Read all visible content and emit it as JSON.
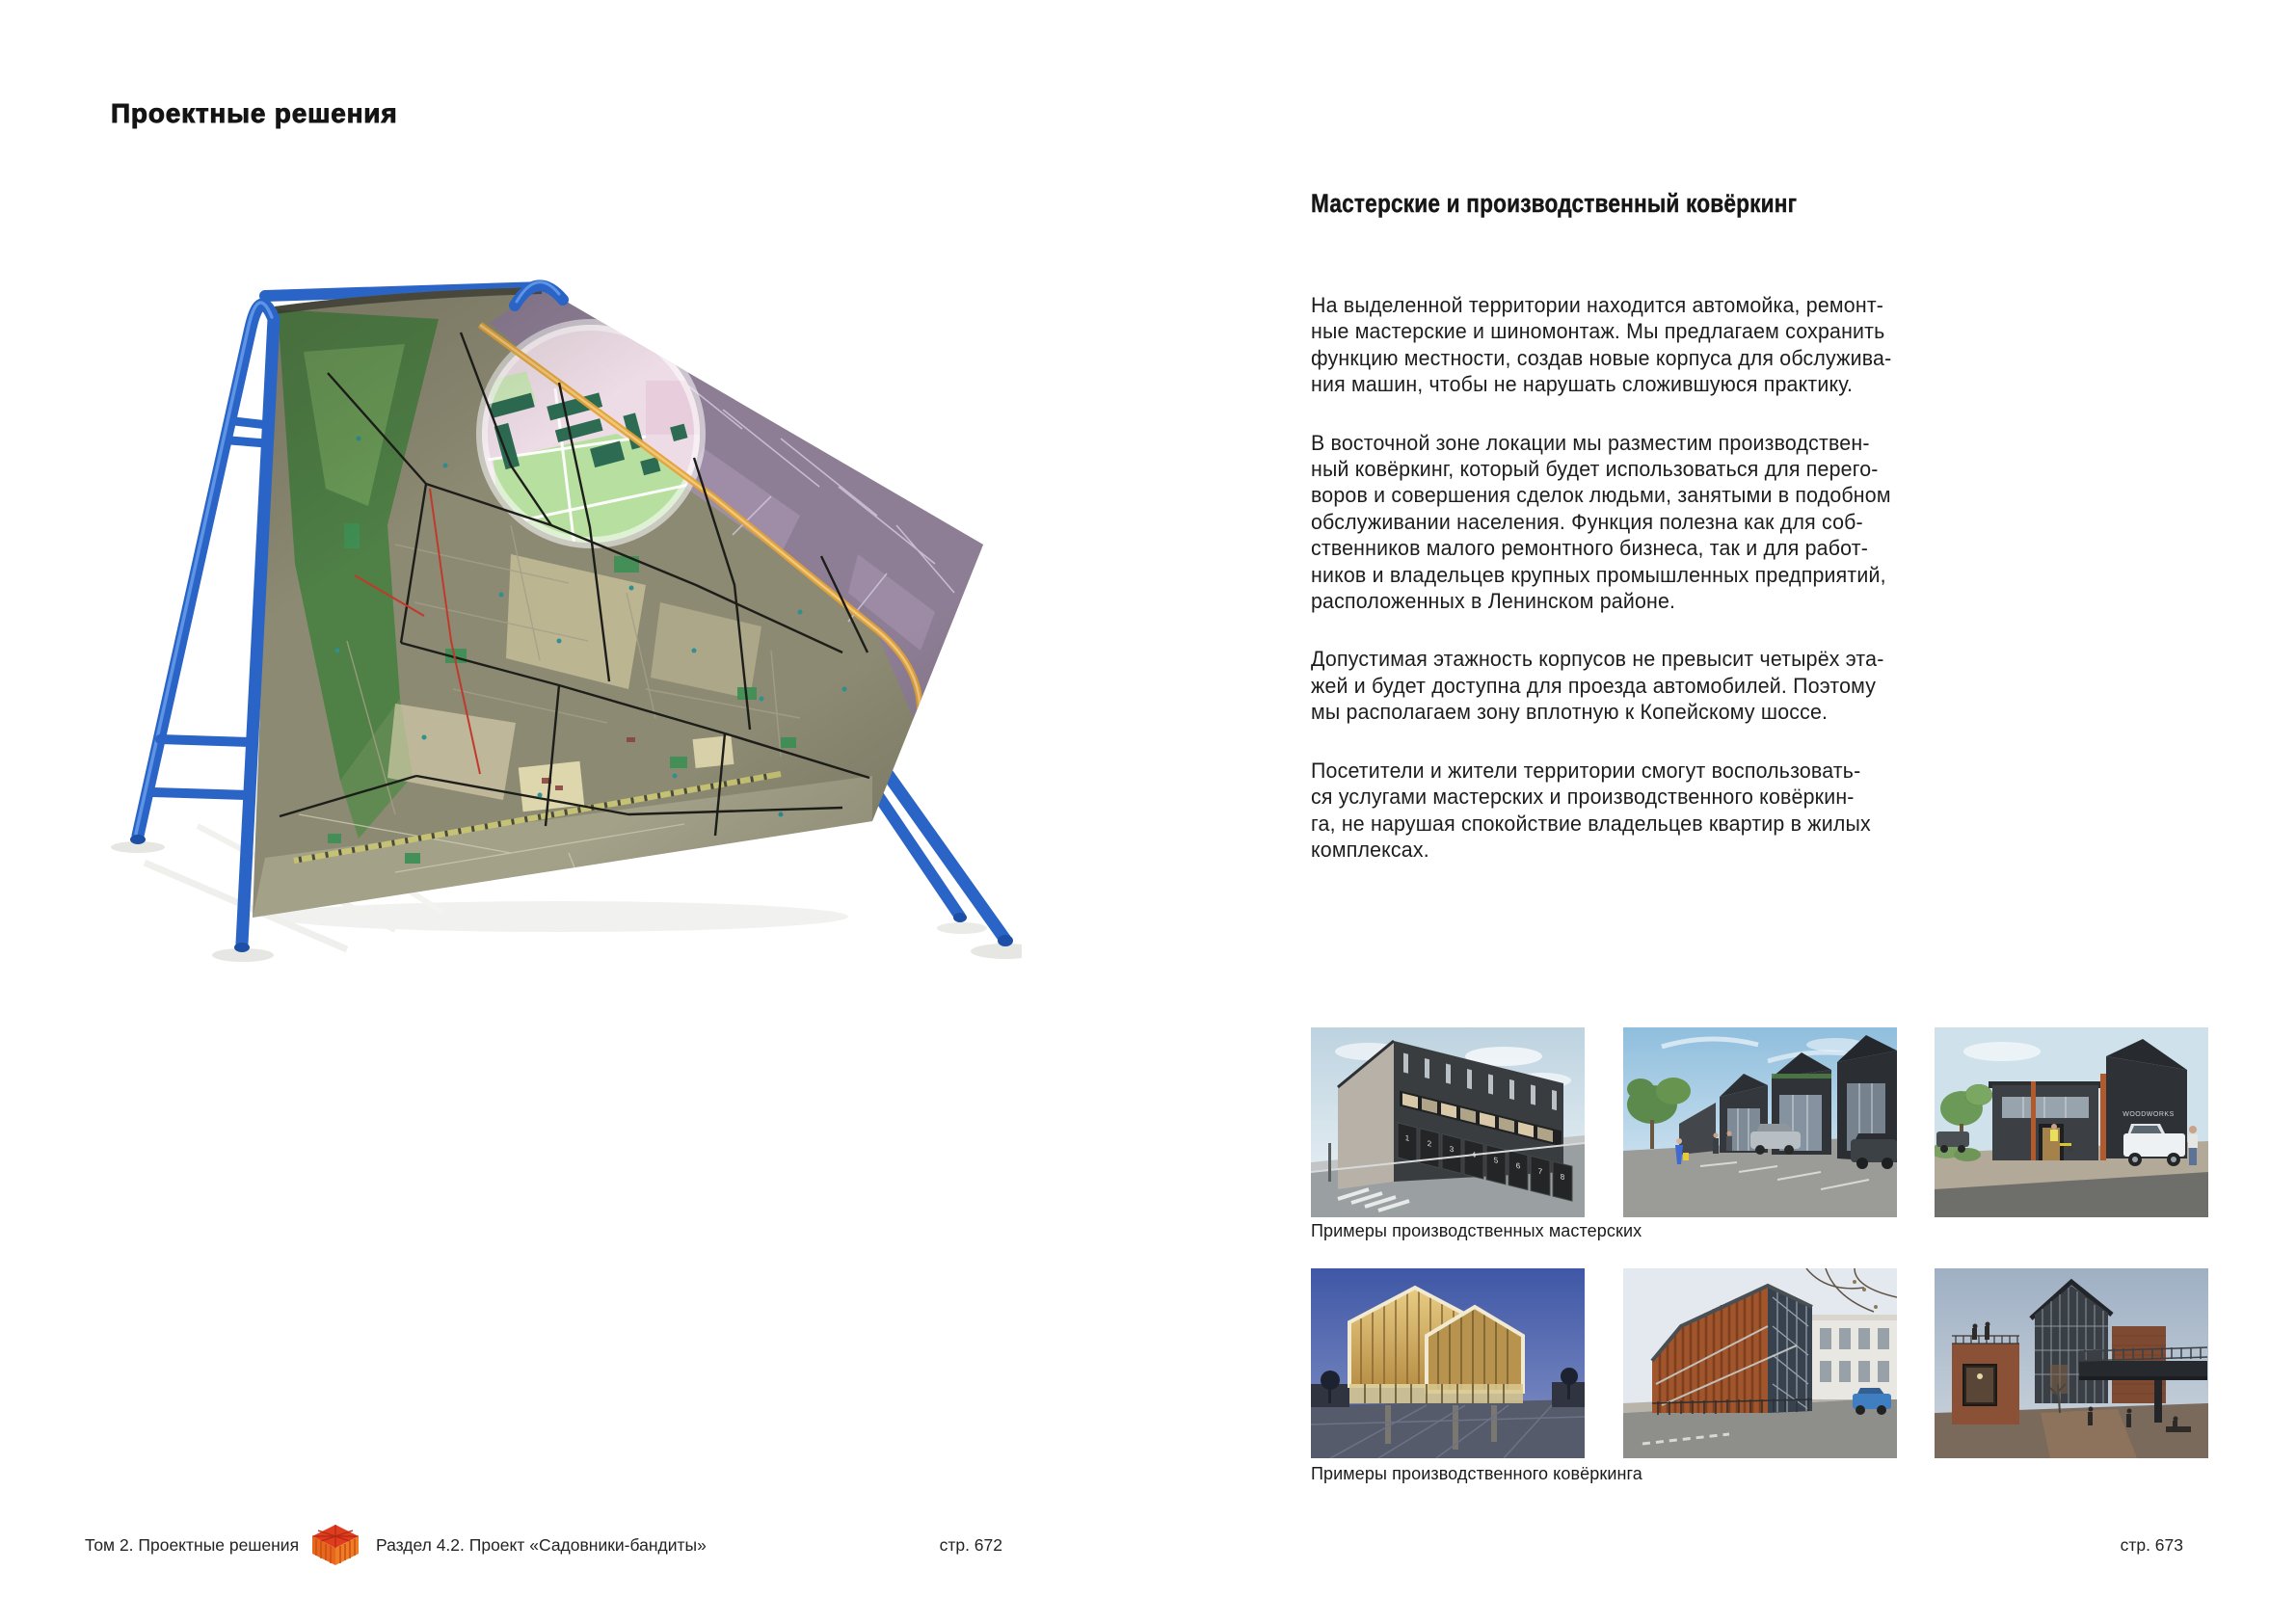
{
  "left": {
    "title": "Проектные решения",
    "illustration_alt": "Карта Ленинского района, накинутая как полотно на синюю трубчатую А-образную раму; белым кругом выделена зона мастерских"
  },
  "right": {
    "heading": "Мастерские и производственный ковёркинг",
    "paragraphs": [
      "На выделенной территории находится автомойка, ремонт-\nные мастерские и шиномонтаж. Мы предлагаем сохранить\nфункцию местности, создав новые корпуса для обслужива-\nния машин, чтобы не нарушать сложившуюся практику.",
      "В восточной зоне локации мы разместим производствен-\nный ковёркинг, который будет использоваться для перего-\nворов и совершения сделок людьми, занятыми в подобном\nобслуживании населения. Функция полезна как для соб-\nственников малого ремонтного бизнеса, так и для работ-\nников и владельцев крупных промышленных предприятий,\nрасположенных в Ленинском районе.",
      "Допустимая этажность корпусов не превысит четырёх эта-\nжей и будет доступна для проезда автомобилей. Поэтому\nмы располагаем зону вплотную к Копейскому шоссе.",
      "Посетители и жители территории смогут воспользовать-\nся услугами мастерских и производственного ковёркин-\nга, не нарушая спокойствие владельцев квартир в жилых\nкомплексах."
    ],
    "galleries": [
      {
        "caption": "Примеры производственных мастерских",
        "photos": [
          {
            "alt": "Тёмное здание мастерских с пронумерованными гаражными воротами",
            "door_numbers": [
              "1",
              "2",
              "3",
              "4",
              "5",
              "6",
              "7",
              "8"
            ]
          },
          {
            "alt": "Улица с рядом тёмных корпусов мастерских, парковкой и людьми"
          },
          {
            "alt": "Мастерские с белым пикапом и людьми у входа",
            "signage": "WOODWORKS"
          }
        ]
      },
      {
        "caption": "Примеры производственного ковёркинга",
        "photos": [
          {
            "alt": "Вечернее здание с двумя светящимися щипцовыми фасадами"
          },
          {
            "alt": "Здание с кортеновским фасадом и стеклянным атриумом рядом с классическим домом"
          },
          {
            "alt": "Кирпичные корпуса со стеклянной щипцовой башней и надземным переходом"
          }
        ]
      }
    ]
  },
  "footer": {
    "volume": "Том 2. Проектные решения",
    "section": "Раздел 4.2. Проект «Садовники-бандиты»",
    "page_left": "стр. 672",
    "page_right": "стр. 673"
  }
}
